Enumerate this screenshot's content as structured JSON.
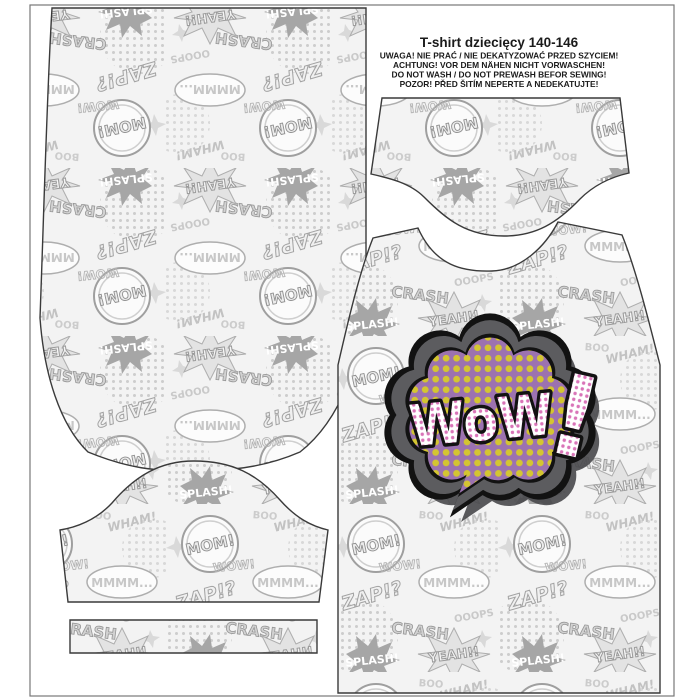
{
  "header": {
    "title": "T-shirt  dziecięcy 140-146",
    "warnings": [
      "UWAGA! NIE PRAĆ / NIE DEKATYZOWAĆ PRZED SZYCIEM!",
      "ACHTUNG! VOR DEM NÄHEN NICHT VORWASCHEN!",
      "DO NOT WASH / DO NOT PREWASH BEFOR SEWING!",
      "POZOR! PŘED ŠITÍM NEPERTE A NEDEKATUJTE!"
    ]
  },
  "wow_badge": {
    "word": "WoW",
    "exclamation": "!"
  },
  "fabric_pattern": {
    "words": {
      "mom": "MOM!",
      "zap": "ZAP!?",
      "yeah": "YEAH!!",
      "crash": "CRASH",
      "splash": "SPLASH!",
      "wham": "WHAM!",
      "ooops": "OOOPS",
      "mmmm": "MMMM...",
      "boo": "BOO",
      "wow": "WOW!"
    }
  },
  "colors": {
    "wow_purple": "#9c72b0",
    "wow_yellow_dots": "#d4c531",
    "wow_pink_dots": "#d974b8",
    "wow_border_gray": "#5c5c5f",
    "outline_black": "#121212",
    "print_gray_light": "#f3f3f3",
    "print_gray_mid": "#c8c8c8",
    "print_gray_dark": "#9a9a9a"
  }
}
